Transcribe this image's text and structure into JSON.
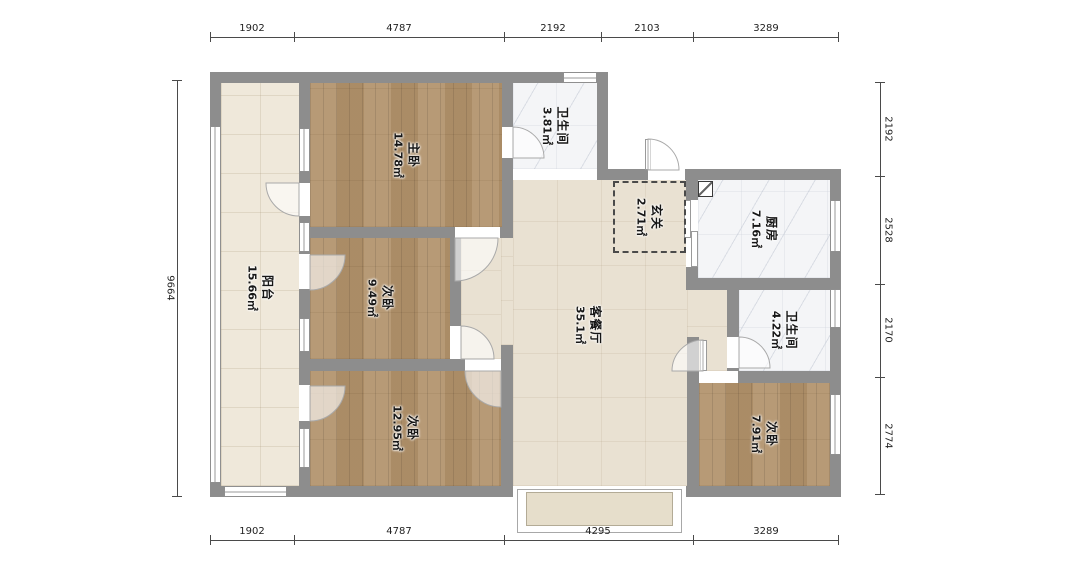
{
  "plan": {
    "type": "apartment-floor-plan",
    "unit_hint": "mm"
  },
  "rooms": [
    {
      "name": "阳台",
      "area": "15.66㎡"
    },
    {
      "name": "主卧",
      "area": "14.78㎡"
    },
    {
      "name": "卫生间",
      "area": "3.81㎡"
    },
    {
      "name": "玄关",
      "area": "2.71㎡"
    },
    {
      "name": "厨房",
      "area": "7.16㎡"
    },
    {
      "name": "客餐厅",
      "area": "35.1㎡"
    },
    {
      "name": "卫生间",
      "area": "4.22㎡"
    },
    {
      "name": "次卧",
      "area": "9.49㎡"
    },
    {
      "name": "次卧",
      "area": "12.95㎡"
    },
    {
      "name": "次卧",
      "area": "7.91㎡"
    }
  ],
  "dimensions": {
    "top": [
      "1902",
      "4787",
      "2192",
      "2103",
      "3289"
    ],
    "bottom": [
      "1902",
      "4787",
      "4295",
      "3289"
    ],
    "left": [
      "9664"
    ],
    "right": [
      "2192",
      "2528",
      "2170",
      "2774"
    ]
  },
  "colors": {
    "wall": "#8d8d8d",
    "wood_floor": "#b3946d",
    "balcony_tile": "#efe8da",
    "living_tile": "#e9e1d2",
    "wet_room_tile": "#f4f5f7",
    "bay_sill": "#e6decb"
  }
}
